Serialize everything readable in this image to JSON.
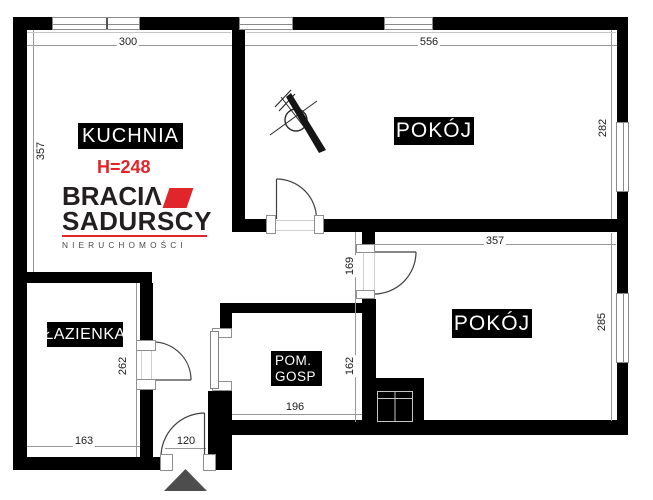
{
  "plan": {
    "rooms": {
      "kitchen": {
        "label": "KUCHNIA",
        "height_note": "H=248"
      },
      "room_top": {
        "label": "POKÓJ"
      },
      "room_bottom": {
        "label": "POKÓJ"
      },
      "bathroom": {
        "label": "ŁAZIENKA"
      },
      "utility": {
        "label_line1": "POM.",
        "label_line2": "GOSP"
      }
    },
    "dimensions": {
      "kitchen_width": "300",
      "room_top_width": "556",
      "kitchen_height": "357",
      "room_top_height": "282",
      "room_bottom_width": "357",
      "room_bottom_height": "285",
      "hall_height": "169",
      "utility_height": "162",
      "utility_width": "196",
      "bathroom_height": "262",
      "bathroom_width": "163",
      "entrance_width": "120"
    },
    "logo": {
      "line1": "BRACIΛ",
      "line2": "SADURSCY",
      "line3": "NIERUCHOMOŚCI",
      "accent_color": "#e0262b"
    },
    "symbols": {
      "lamp_point": "crossed-circle",
      "entrance_marker": "triangle-up"
    },
    "colors": {
      "wall": "#000000",
      "dim_text": "#1c1c1c"
    }
  }
}
